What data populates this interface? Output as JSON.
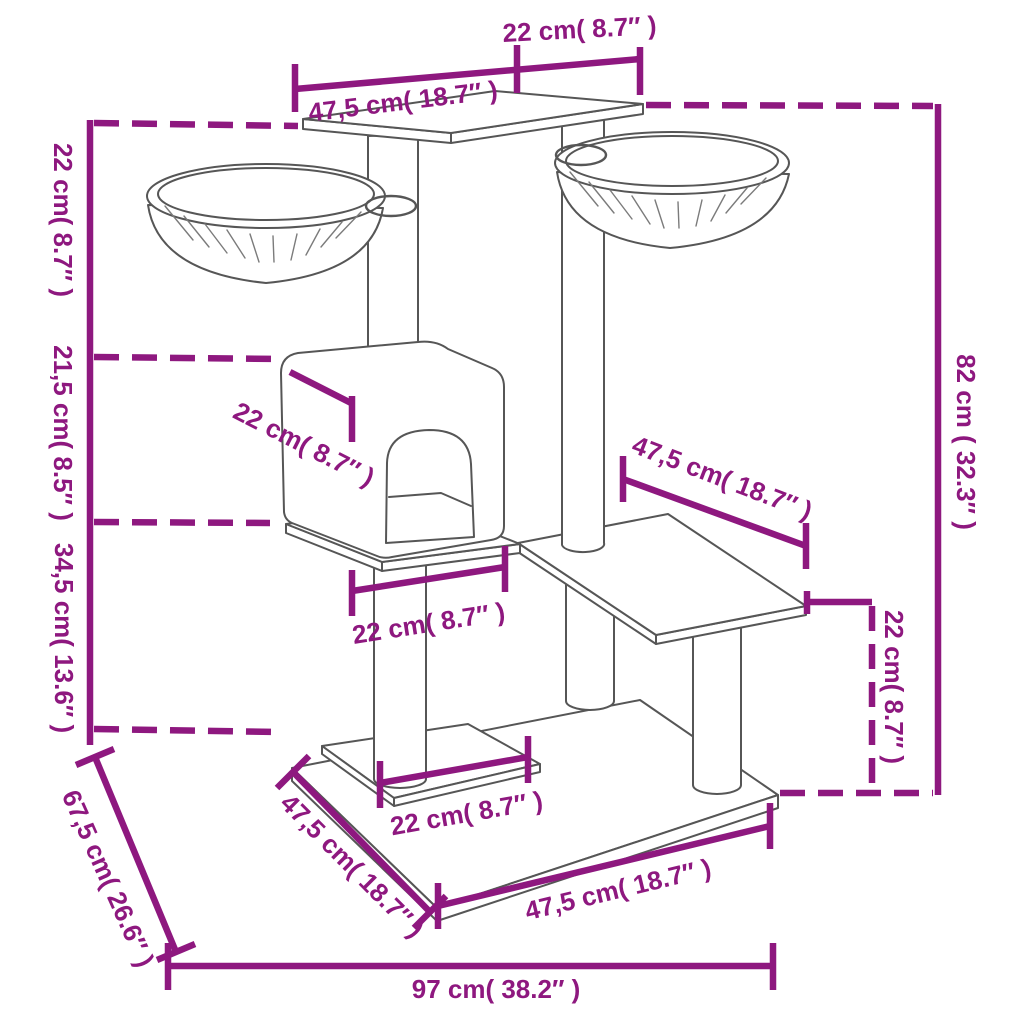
{
  "diagram": {
    "colors": {
      "accent": "#8E187F",
      "line": "#565656",
      "background": "#FFFFFF"
    },
    "dimensions": [
      {
        "id": "top-platform-depth",
        "label": "22 cm( 8.7″ )",
        "cm": "22",
        "inches": "8.7"
      },
      {
        "id": "top-platform-length",
        "label": "47,5 cm( 18.7″ )",
        "cm": "47,5",
        "inches": "18.7"
      },
      {
        "id": "basket-level-height",
        "label": "22 cm( 8.7″ )",
        "cm": "22",
        "inches": "8.7"
      },
      {
        "id": "house-height",
        "label": "21,5 cm( 8.5″ )",
        "cm": "21,5",
        "inches": "8.5"
      },
      {
        "id": "middle-level-height",
        "label": "34,5 cm( 13.6″ )",
        "cm": "34,5",
        "inches": "13.6"
      },
      {
        "id": "base-depth",
        "label": "67,5 cm( 26.6″ )",
        "cm": "67,5",
        "inches": "26.6"
      },
      {
        "id": "base-width",
        "label": "97 cm( 38.2″ )",
        "cm": "97",
        "inches": "38.2"
      },
      {
        "id": "total-height",
        "label": "82 cm ( 32.3″ )",
        "cm": "82",
        "inches": "32.3"
      },
      {
        "id": "side-platform-height",
        "label": "22 cm( 8.7″ )",
        "cm": "22",
        "inches": "8.7"
      },
      {
        "id": "side-platform-length",
        "label": "47,5 cm( 18.7″ )",
        "cm": "47,5",
        "inches": "18.7"
      },
      {
        "id": "house-roof-depth",
        "label": "22 cm( 8.7″ )",
        "cm": "22",
        "inches": "8.7"
      },
      {
        "id": "middle-platform-depth",
        "label": "22 cm( 8.7″ )",
        "cm": "22",
        "inches": "8.7"
      },
      {
        "id": "bottom-platform-depth",
        "label": "22 cm( 8.7″ )",
        "cm": "22",
        "inches": "8.7"
      },
      {
        "id": "base-left-edge-length",
        "label": "47,5 cm( 18.7″ )",
        "cm": "47,5",
        "inches": "18.7"
      },
      {
        "id": "base-front-edge-length",
        "label": "47,5 cm( 18.7″ )",
        "cm": "47,5",
        "inches": "18.7"
      }
    ]
  }
}
